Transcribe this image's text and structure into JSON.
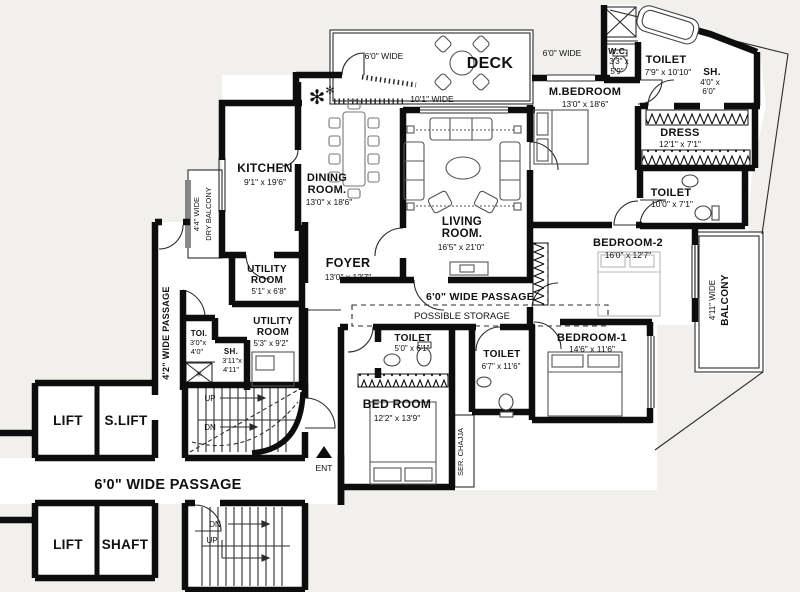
{
  "title": "Apartment Floor Plan",
  "colors": {
    "background": "#f1f0ec",
    "wall": "#0d0d0d",
    "thin_line": "#2b2b2b",
    "furniture": "#555555",
    "faint_furniture": "#b9b9b9",
    "room_fill": "#ffffff"
  },
  "rooms": {
    "deck": {
      "label": "DECK",
      "width_note": "10'1\" WIDE",
      "side_note_left": "6'0\" WIDE",
      "side_note_right": "6'0\" WIDE"
    },
    "kitchen": {
      "label": "KITCHEN",
      "dims": "9'1\" x 19'6\""
    },
    "dining_room": {
      "label_line1": "DINING",
      "label_line2": "ROOM.",
      "dims": "13'0\" x 18'6\""
    },
    "living_room": {
      "label_line1": "LIVING",
      "label_line2": "ROOM.",
      "dims": "16'5\" x 21'0\""
    },
    "master_bedroom": {
      "label": "M.BEDROOM",
      "dims": "13'0\" x 18'6\""
    },
    "wc": {
      "label": "W.C.",
      "dims_line1": "3'3\" x",
      "dims_line2": "5'9\""
    },
    "toilet_top": {
      "label": "TOILET",
      "dims": "7'9\" x 10'10\""
    },
    "shower_top": {
      "label": "SH.",
      "dims_line1": "4'0\" x",
      "dims_line2": "6'0\""
    },
    "dress": {
      "label": "DRESS",
      "dims": "12'1\" x 7'1\""
    },
    "toilet_right": {
      "label": "TOILET",
      "dims": "10'0\" x 7'1\""
    },
    "bedroom2": {
      "label": "BEDROOM-2",
      "dims": "16'0\" x 12'7\""
    },
    "balcony_right": {
      "label_line1": "4'11\" WIDE",
      "label_line2": "BALCONY"
    },
    "dry_balcony": {
      "label_line1": "4'4\" WIDE",
      "label_line2": "DRY BALCONY"
    },
    "foyer": {
      "label": "FOYER",
      "dims": "13'0\" x 12'7\""
    },
    "utility_room_upper": {
      "label_line1": "UTILITY",
      "label_line2": "ROOM",
      "dims": "5'1\" x 6'8\""
    },
    "utility_room_lower": {
      "label_line1": "UTILITY",
      "label_line2": "ROOM",
      "dims": "5'3\" x 9'2\""
    },
    "toi": {
      "label": "TOI.",
      "dims_line1": "3'0\"x",
      "dims_line2": "4'0\""
    },
    "shower_small": {
      "label": "SH.",
      "dims_line1": "3'11\"x",
      "dims_line2": "4'11\""
    },
    "toilet_bedroom": {
      "label": "TOILET",
      "dims": "5'0\" x 6'1\""
    },
    "toilet_middle": {
      "label": "TOILET",
      "dims": "6'7\" x 11'6\""
    },
    "bed_room": {
      "label": "BED ROOM",
      "dims": "12'2\" x 13'9\""
    },
    "bedroom1": {
      "label": "BEDROOM-1",
      "dims": "14'6\" x 11'6\""
    },
    "lift_upper": {
      "label": "LIFT"
    },
    "s_lift": {
      "label": "S.LIFT"
    },
    "lift_lower": {
      "label": "LIFT"
    },
    "shaft": {
      "label": "SHAFT"
    }
  },
  "passages": {
    "middle": "6'0\" WIDE PASSAGE",
    "bottom": "6'0\" WIDE PASSAGE",
    "side": "4'2\" WIDE PASSAGE"
  },
  "annotations": {
    "possible_storage": "POSSIBLE STORAGE",
    "ser_chajja": "SER. CHAJJA",
    "entrance": "ENT",
    "stairs_upper_up": "UP",
    "stairs_upper_dn": "DN",
    "stairs_lower_dn": "DN",
    "stairs_lower_up": "UP"
  },
  "icons": {
    "plant": "✻",
    "star": "✳"
  }
}
